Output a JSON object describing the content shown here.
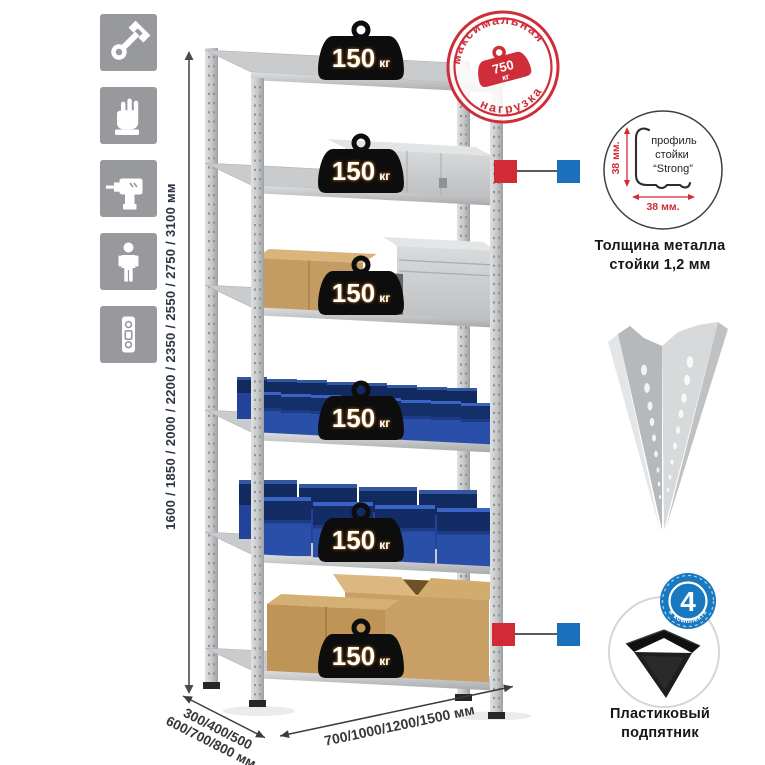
{
  "colors": {
    "stamp_red": "#cf2e39",
    "marker_red": "#d32b35",
    "marker_blue": "#1c6fba",
    "badge_blue": "#1879c0",
    "bin_blue": "#2a4fa8",
    "icon_gray": "#97999c",
    "metal_gray": "#c6c8ca",
    "dim_text": "#2b3442"
  },
  "left_icons": [
    {
      "name": "wrench"
    },
    {
      "name": "gloves"
    },
    {
      "name": "drill"
    },
    {
      "name": "person"
    },
    {
      "name": "level"
    }
  ],
  "dimensions": {
    "height_label": "1600 / 1850 / 2000 / 2200 / 2350 / 2550 / 2750 / 3100 мм",
    "depth_line1": "300/400/500",
    "depth_line2": "600/700/800 мм",
    "width_label": "700/1000/1200/1500 мм"
  },
  "stamp": {
    "arc_top": "максимальная",
    "arc_bottom": "нагрузка",
    "value": "750",
    "unit": "кг"
  },
  "rack": {
    "shelves": [
      {
        "load": "150",
        "unit": "кг"
      },
      {
        "load": "150",
        "unit": "кг"
      },
      {
        "load": "150",
        "unit": "кг"
      },
      {
        "load": "150",
        "unit": "кг"
      },
      {
        "load": "150",
        "unit": "кг"
      },
      {
        "load": "150",
        "unit": "кг"
      }
    ]
  },
  "profile_detail": {
    "line1": "профиль",
    "line2": "стойки",
    "line3": "“Strong”",
    "dim_vertical": "38 мм.",
    "dim_horizontal": "38 мм.",
    "caption1": "Толщина металла",
    "caption2": "стойки 1,2 мм"
  },
  "foot_detail": {
    "badge_number": "4",
    "badge_arc": "в комплекте",
    "caption1": "Пластиковый",
    "caption2": "подпятник"
  }
}
